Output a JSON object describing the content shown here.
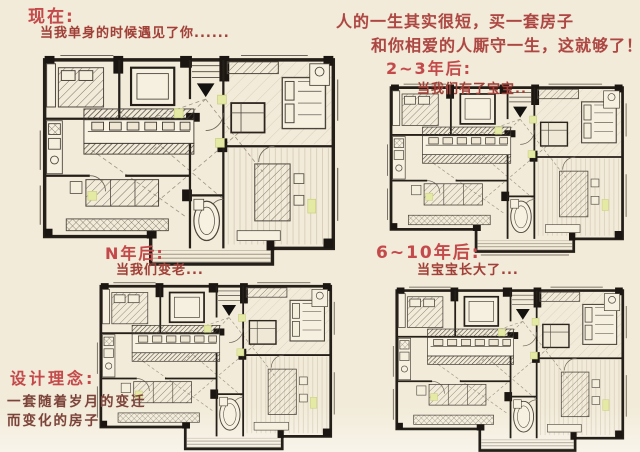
{
  "colors": {
    "bg": "#f2ebd9",
    "title-red": "#c4494b",
    "caption-red": "#a04038",
    "quote-red": "#ad4743",
    "concept-red": "#7b443a",
    "ink": "#2a241d",
    "accent-green": "#e4e9a3"
  },
  "quote": {
    "line1": "人的一生其实很短，买一套房子",
    "line2": "和你相爱的人厮守一生，这就够了！"
  },
  "stages": {
    "now": {
      "title": "现在:",
      "caption": "当我单身的时候遇见了你......"
    },
    "two_three": {
      "title": "2~3年后:",
      "caption": "当我们有了宝宝.."
    },
    "n_years": {
      "title": "N年后:",
      "caption": "当我们变老..."
    },
    "six_ten": {
      "title": "6~10年后:",
      "caption": "当宝宝长大了..."
    }
  },
  "concept": {
    "title": "设计理念:",
    "line1": "一套随着岁月的变迁",
    "line2": "而变化的房子"
  }
}
